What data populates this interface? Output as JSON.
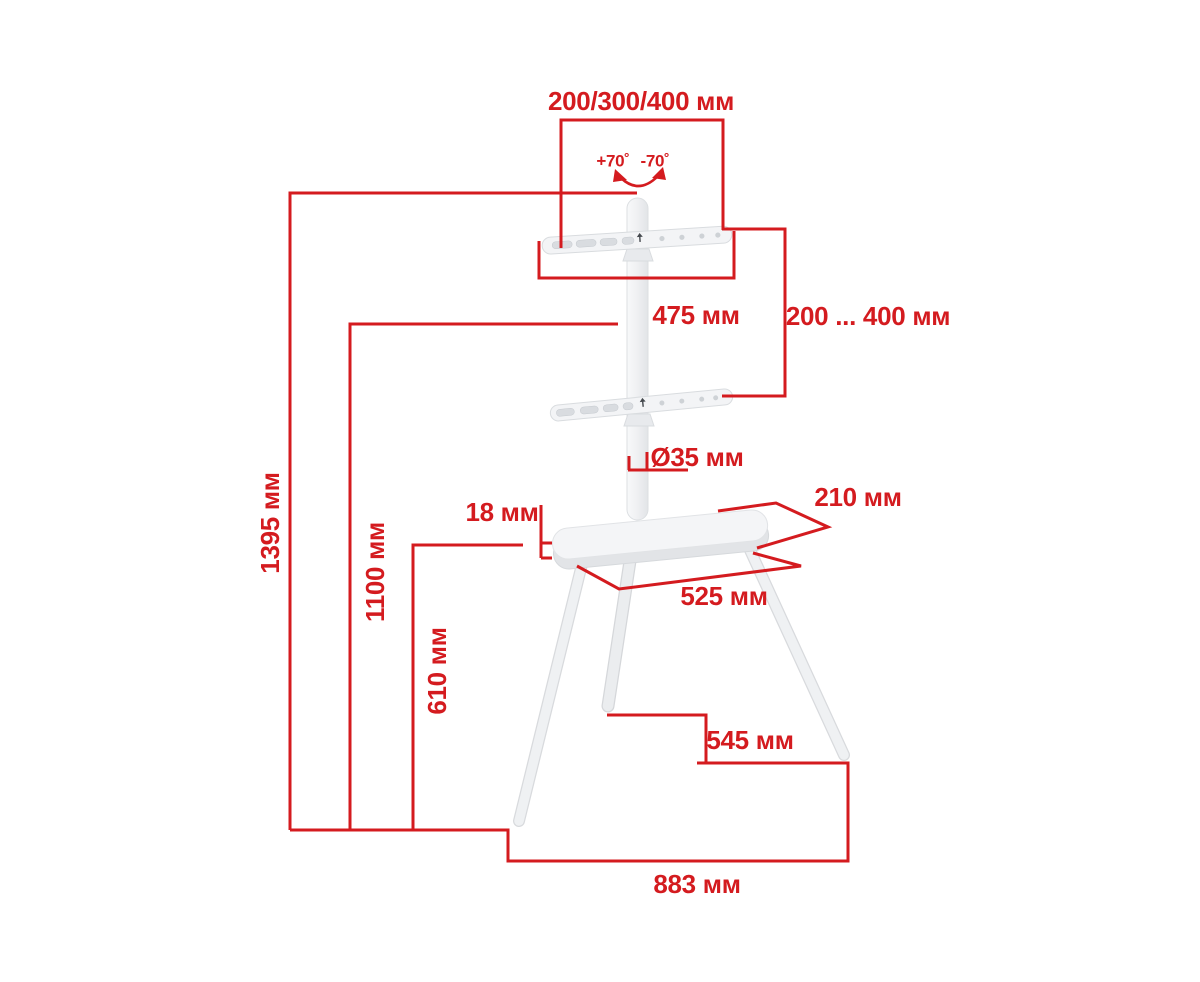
{
  "diagram": {
    "labels": {
      "vesa_width": "200/300/400 мм",
      "tilt_cw": "+70˚",
      "tilt_ccw": "-70˚",
      "bracket_width": "475 мм",
      "vesa_height_range": "200 ... 400 мм",
      "pole_diameter": "Ø35 мм",
      "shelf_depth": "210 мм",
      "shelf_thickness": "18 мм",
      "shelf_width": "525 мм",
      "total_height": "1395 мм",
      "mount_height": "1100 мм",
      "shelf_height": "610 мм",
      "base_depth": "545 мм",
      "base_width": "883 мм"
    },
    "colors": {
      "dimension_red": "#d41b1f",
      "stand_white": "#f3f4f6",
      "background": "#ffffff"
    }
  }
}
